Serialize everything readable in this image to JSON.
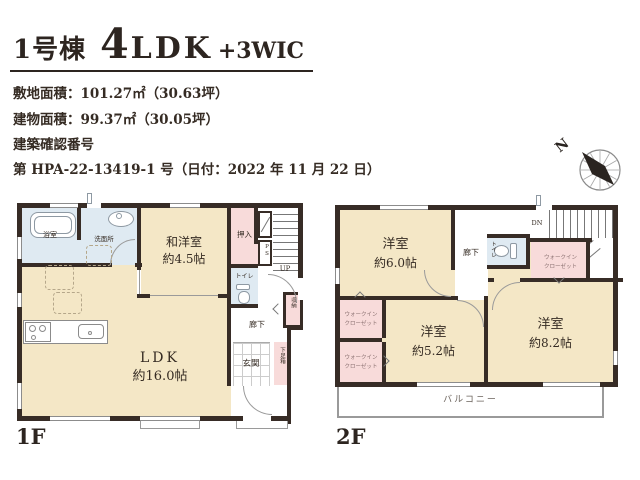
{
  "colors": {
    "wall": "#372c26",
    "floor_beige": "#f4e7c6",
    "floor_blue": "#dfeaf2",
    "floor_pink": "#f8dbda",
    "text": "#332a24"
  },
  "header": {
    "building_no": "1号棟",
    "plan_big": "4",
    "plan_mid": "LDK",
    "plan_small": "+3WIC",
    "site_area": "敷地面積：101.27㎡（30.63坪）",
    "building_area": "建物面積：99.37㎡（30.05坪）",
    "confirm_label": "建築確認番号",
    "confirm_no": "第 HPA-22-13419-1 号（日付：2022 年 11 月 22 日）"
  },
  "compass": {
    "north": "N"
  },
  "floor1": {
    "label": "1F",
    "bath": "浴室",
    "washroom": "洗面所",
    "tatami_room": "和洋室",
    "tatami_size": "約4.5帖",
    "oshiire": "押入",
    "ps": "PS",
    "up": "UP",
    "toilet": "トイレ",
    "storage": "収納",
    "hall": "廊下",
    "entrance": "玄関",
    "shoe_box": "下足箱",
    "ldk": "LDK",
    "ldk_size": "約16.0帖"
  },
  "floor2": {
    "label": "2F",
    "room_a": "洋室",
    "room_a_size": "約6.0帖",
    "hall": "廊下",
    "dn": "DN",
    "toilet": "トイレ",
    "wic_line1": "ウォークイン",
    "wic_line2": "クローゼット",
    "room_b": "洋室",
    "room_b_size": "約5.2帖",
    "room_c": "洋室",
    "room_c_size": "約8.2帖",
    "balcony": "バルコニー"
  }
}
